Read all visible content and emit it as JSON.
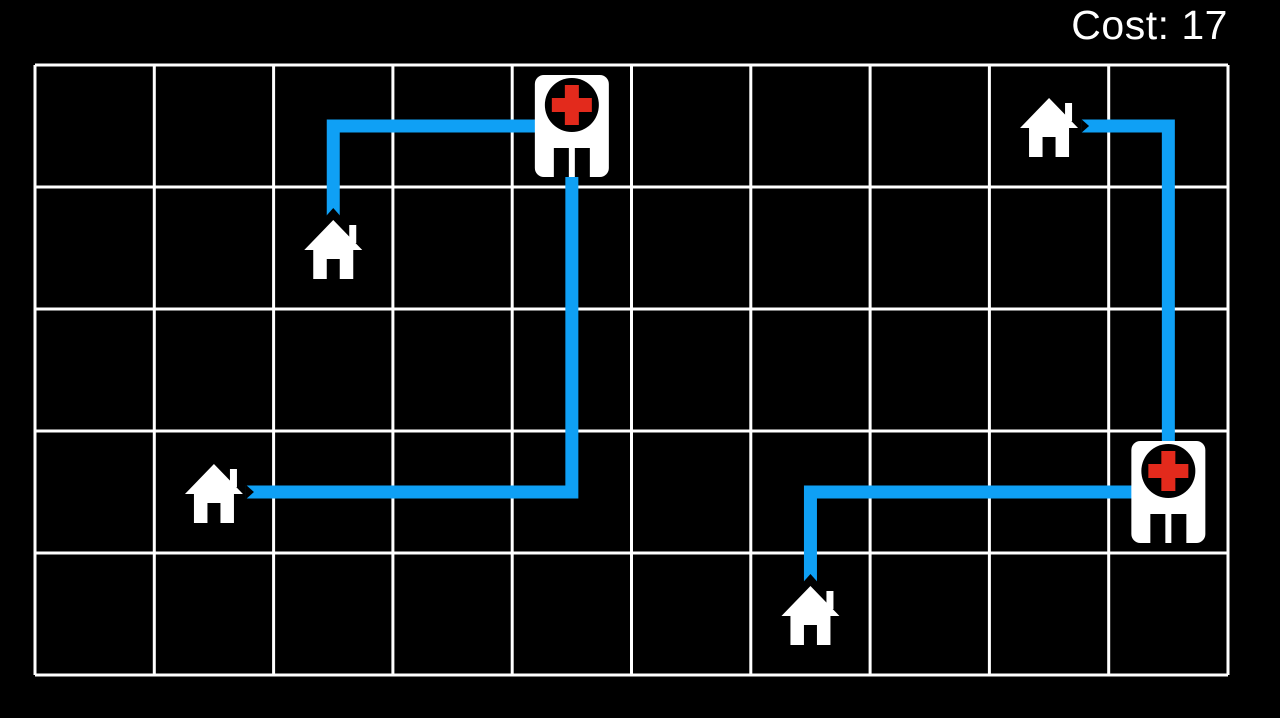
{
  "hud": {
    "cost_text": "Cost: 17",
    "cost_value": 17
  },
  "board": {
    "grid": {
      "cols": 10,
      "rows": 5,
      "left": 35,
      "top": 65,
      "right": 1228,
      "bottom": 675,
      "line_color": "#ffffff",
      "line_width": 3
    },
    "colors": {
      "background": "#000000",
      "route": "#0FA0F5",
      "icon_fill": "#ffffff",
      "hospital_cross": "#E32A1C",
      "hospital_detail": "#000000"
    },
    "route_style": {
      "width": 13,
      "house_end_offset": 32,
      "notch_depth": 8
    },
    "entities": [
      {
        "type": "hospital",
        "id": "hospital-1",
        "col": 4,
        "row": 0
      },
      {
        "type": "hospital",
        "id": "hospital-2",
        "col": 9,
        "row": 3
      },
      {
        "type": "house",
        "id": "house-1",
        "col": 8,
        "row": 0
      },
      {
        "type": "house",
        "id": "house-2",
        "col": 2,
        "row": 1
      },
      {
        "type": "house",
        "id": "house-3",
        "col": 1,
        "row": 3
      },
      {
        "type": "house",
        "id": "house-4",
        "col": 6,
        "row": 4
      }
    ],
    "routes": [
      {
        "id": "route-house-2-to-hospital-1",
        "from": "house-2",
        "to": "hospital-1",
        "cost": 3,
        "cells": [
          [
            2,
            1
          ],
          [
            2,
            0
          ],
          [
            4,
            0
          ]
        ]
      },
      {
        "id": "route-house-3-to-hospital-1",
        "from": "house-3",
        "to": "hospital-1",
        "cost": 6,
        "cells": [
          [
            1,
            3
          ],
          [
            4,
            3
          ],
          [
            4,
            0
          ]
        ]
      },
      {
        "id": "route-house-1-to-hospital-2",
        "from": "house-1",
        "to": "hospital-2",
        "cost": 4,
        "cells": [
          [
            8,
            0
          ],
          [
            9,
            0
          ],
          [
            9,
            3
          ]
        ]
      },
      {
        "id": "route-house-4-to-hospital-2",
        "from": "house-4",
        "to": "hospital-2",
        "cost": 4,
        "cells": [
          [
            6,
            4
          ],
          [
            6,
            3
          ],
          [
            9,
            3
          ]
        ]
      }
    ]
  }
}
